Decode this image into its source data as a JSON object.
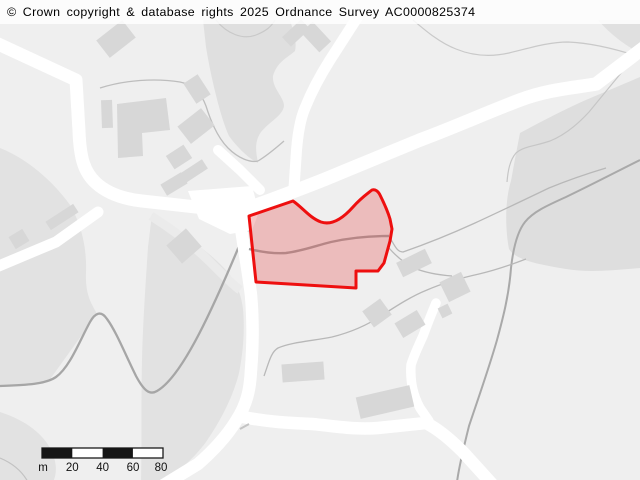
{
  "attribution": {
    "text": "© Crown copyright & database rights 2025 Ordnance Survey AC0000825374"
  },
  "scalebar": {
    "unit_label": "m",
    "tick_labels": [
      "20",
      "40",
      "60",
      "80"
    ],
    "segment_metres": 20,
    "total_metres": 80
  },
  "palette": {
    "background": "#efefef",
    "field_area": "#e2e2e2",
    "woodland_area": "#dfdfdf",
    "hillside_area": "#dedede",
    "road": "#ffffff",
    "building": "#d7d7d7",
    "contour": "#c9c9c9",
    "track": "#a6a6a6",
    "parcel_stroke": "#ee0f0f",
    "parcel_fill": "rgba(232,85,85,0.33)",
    "scalebar_dark": "#151515",
    "text": "#000000"
  },
  "map": {
    "width": 640,
    "height": 480,
    "layers": [
      {
        "name": "area-left-field",
        "kind": "path",
        "d": "M0,148 C30,160 55,184 70,205 C80,222 87,245 86,272 C85,296 92,304 97,314 L48,382 C32,386 15,387 0,387 Z",
        "fill": "#e2e2e2"
      },
      {
        "name": "area-bottomleft-field",
        "kind": "path",
        "d": "M0,412 C25,420 44,434 52,452 C58,466 56,476 53,482 L0,482 Z",
        "fill": "#e2e2e2"
      },
      {
        "name": "area-top-woodland",
        "kind": "path",
        "d": "M203,20 L290,20 C294,33 297,42 295,51 C287,58 277,62 273,76 C272,88 283,96 284,105 C284,115 269,122 261,132 C254,142 256,152 258,163 C248,158 237,147 229,136 C221,119 211,78 206,47 Z",
        "fill": "#dfdfdf"
      },
      {
        "name": "area-hillside",
        "kind": "path",
        "d": "M520,133 C546,119 573,105 600,94 L640,77 L640,268 C615,270 590,273 566,269 C543,265 516,261 509,249 C505,228 505,200 511,181 C514,164 517,148 520,133 Z",
        "fill": "#dedede"
      },
      {
        "name": "area-topright-corner",
        "kind": "path",
        "d": "M598,20 L640,20 L640,53 C626,46 611,35 598,20 Z",
        "fill": "#e0e0e0"
      },
      {
        "name": "area-center-field",
        "kind": "path",
        "d": "M152,214 C176,229 206,249 224,268 C236,281 241,293 243,309 C245,331 243,353 239,373 C233,397 221,420 206,442 C191,462 173,476 161,482 L141,482 C142,440 141,400 142,360 C143,320 146,278 148,247 Z",
        "fill": "#e2e2e2"
      },
      {
        "name": "track-junction-band",
        "kind": "path",
        "d": "M151,216 Q186,238 210,262 T240,290",
        "stroke": "#ebebeb",
        "width": 9
      },
      {
        "name": "contour-top-left",
        "kind": "path",
        "d": "M216,20 C227,34 243,40 256,35 C266,31 271,27 275,20",
        "stroke": "#c9c9c9",
        "width": 1.2
      },
      {
        "name": "contour-top-right",
        "kind": "path",
        "d": "M413,20 C426,31 440,43 456,49 C473,56 491,57 509,53 C530,48 548,42 568,42 C592,43 616,49 640,57",
        "stroke": "#c9c9c9",
        "width": 1.2
      },
      {
        "name": "contour-hillside",
        "kind": "path",
        "d": "M626,67 C612,84 599,100 589,112 C578,124 565,135 550,141 C536,146 524,146 516,153 C510,160 508,170 507,182",
        "stroke": "#c6c6c6",
        "width": 1.2
      },
      {
        "name": "track-scurve",
        "kind": "path",
        "d": "M0,386 C28,385 46,384 56,377 C70,367 80,340 90,322 C95,313 101,310 107,319 C116,331 126,356 136,376 C143,389 149,396 157,391 C171,383 186,359 199,334 C213,307 226,277 237,251 C241,241 244,234 248,230",
        "stroke": "#a6a6a6",
        "width": 2.3
      },
      {
        "name": "track-hillside-long",
        "kind": "path",
        "d": "M640,160 C616,172 591,185 566,197 C546,206 533,212 525,222 C517,232 513,250 511,268 C509,295 503,318 497,340 C489,368 479,396 469,426 C464,446 459,466 457,482",
        "stroke": "#a9a9a9",
        "width": 2
      },
      {
        "name": "path-upper-left",
        "kind": "path",
        "d": "M100,88 C125,80 155,78 180,82 C195,85 202,95 206,106 C211,122 218,138 228,148 C238,158 250,163 258,161 M258,161 C268,155 276,148 284,141",
        "stroke": "#bdbdbd",
        "width": 1.3
      },
      {
        "name": "path-hill-climb",
        "kind": "path",
        "d": "M390,238 C395,246 397,252 403,252 C426,244 451,234 475,223 C501,211 526,199 549,188 C566,181 586,174 606,168",
        "stroke": "#b8b8b8",
        "width": 1.3
      },
      {
        "name": "path-southeast",
        "kind": "path",
        "d": "M264,376 C269,362 271,352 278,348 C292,342 312,341 332,337 C352,332 368,325 384,314 C398,305 412,296 427,290 C443,283 461,278 479,274 C496,270 513,264 526,259",
        "stroke": "#b8b8b8",
        "width": 1.3
      },
      {
        "name": "path-polygon-east",
        "kind": "path",
        "d": "M389,248 C396,256 404,263 414,268 C426,273 439,275 452,276",
        "stroke": "#b8b8b8",
        "width": 1.3
      },
      {
        "name": "path-corner-arc",
        "kind": "path",
        "d": "M0,458 C12,463 22,471 28,482",
        "stroke": "#c2c2c2",
        "width": 1.2
      },
      {
        "name": "road-northwest",
        "kind": "path",
        "d": "M-6,42 L76,80 L79,131 C80,158 84,172 96,183 C108,194 124,199 142,201 L205,208 L240,212",
        "stroke": "#ffffff",
        "width": 13,
        "cap": "round",
        "join": "round"
      },
      {
        "name": "road-west-branch",
        "kind": "path",
        "d": "M98,212 L56,242 L-6,268",
        "stroke": "#ffffff",
        "width": 11,
        "cap": "round",
        "join": "round"
      },
      {
        "name": "road-north",
        "kind": "path",
        "d": "M357,18 L330,60 C318,79 311,93 305,108 C299,122 297,140 296,158 L294,188",
        "stroke": "#ffffff",
        "width": 11,
        "cap": "round",
        "join": "round"
      },
      {
        "name": "junction-area",
        "kind": "polygon",
        "pts": "188,191 252,186 259,212 252,230 230,234 199,219",
        "fill": "#ffffff"
      },
      {
        "name": "road-main-northeast",
        "kind": "path",
        "d": "M238,212 C275,198 305,188 340,173 L420,140 C455,127 488,112 520,100 C546,90 571,88 596,84 L646,46",
        "stroke": "#ffffff",
        "width": 13.5,
        "cap": "round",
        "join": "round"
      },
      {
        "name": "road-lane-cap",
        "kind": "path",
        "d": "M218,150 L240,170 L260,190",
        "stroke": "#ffffff",
        "width": 10,
        "cap": "round",
        "join": "round"
      },
      {
        "name": "road-south",
        "kind": "path",
        "d": "M240,220 C243,245 248,270 251,295 C253,318 253,345 251,370 C250,390 247,404 236,421 C227,436 212,452 198,464 L162,486",
        "stroke": "#ffffff",
        "width": 12.5,
        "cap": "round",
        "join": "round"
      },
      {
        "name": "road-bottom-east",
        "kind": "path",
        "d": "M243,417 C268,422 290,423 312,424 C334,426 356,430 378,428 L426,423 C438,429 452,441 463,452 L492,484",
        "stroke": "#ffffff",
        "width": 12.5,
        "cap": "round",
        "join": "round"
      },
      {
        "name": "road-driveway",
        "kind": "path",
        "d": "M436,303 C431,315 427,325 423,336 C418,347 414,355 411,365 C410,382 413,395 420,408 L429,421",
        "stroke": "#ffffff",
        "width": 9.5,
        "cap": "round",
        "join": "round"
      },
      {
        "name": "building",
        "kind": "rrect",
        "cx": 116,
        "cy": 39,
        "w": 33,
        "h": 22,
        "rot": -38,
        "fill": "#d7d7d7"
      },
      {
        "name": "building",
        "kind": "rrect",
        "cx": 107,
        "cy": 114,
        "w": 11,
        "h": 28,
        "rot": -2,
        "fill": "#d7d7d7"
      },
      {
        "name": "building-l-shape",
        "kind": "polygon",
        "pts": "117,104 166,98 170,130 142,133 143,156 118,158",
        "fill": "#d7d7d7"
      },
      {
        "name": "building",
        "kind": "rrect",
        "cx": 197,
        "cy": 89,
        "w": 17,
        "h": 24,
        "rot": -33,
        "fill": "#d7d7d7"
      },
      {
        "name": "building",
        "kind": "rrect",
        "cx": 196,
        "cy": 126,
        "w": 30,
        "h": 22,
        "rot": -38,
        "fill": "#d7d7d7"
      },
      {
        "name": "building",
        "kind": "rrect",
        "cx": 179,
        "cy": 157,
        "w": 21,
        "h": 16,
        "rot": -33,
        "fill": "#d7d7d7"
      },
      {
        "name": "building",
        "kind": "rrect",
        "cx": 194,
        "cy": 171,
        "w": 26,
        "h": 11,
        "rot": -33,
        "fill": "#d7d7d7"
      },
      {
        "name": "building",
        "kind": "rrect",
        "cx": 174,
        "cy": 184,
        "w": 24,
        "h": 13,
        "rot": -31,
        "fill": "#d7d7d7"
      },
      {
        "name": "building",
        "kind": "rrect",
        "cx": 184,
        "cy": 246,
        "w": 26,
        "h": 24,
        "rot": -41,
        "fill": "#d7d7d7"
      },
      {
        "name": "building",
        "kind": "rrect",
        "cx": 62,
        "cy": 217,
        "w": 33,
        "h": 10,
        "rot": -33,
        "fill": "#d7d7d7"
      },
      {
        "name": "building",
        "kind": "rrect",
        "cx": 19,
        "cy": 239,
        "w": 16,
        "h": 14,
        "rot": -31,
        "fill": "#d7d7d7"
      },
      {
        "name": "building",
        "kind": "rrect",
        "cx": 296,
        "cy": 33,
        "w": 26,
        "h": 13,
        "rot": -43,
        "fill": "#d7d7d7"
      },
      {
        "name": "building",
        "kind": "rrect",
        "cx": 316,
        "cy": 37,
        "w": 16,
        "h": 27,
        "rot": -43,
        "fill": "#d7d7d7"
      },
      {
        "name": "building",
        "kind": "rrect",
        "cx": 414,
        "cy": 263,
        "w": 32,
        "h": 16,
        "rot": -26,
        "fill": "#d7d7d7"
      },
      {
        "name": "building",
        "kind": "rrect",
        "cx": 455,
        "cy": 287,
        "w": 24,
        "h": 22,
        "rot": -26,
        "fill": "#d7d7d7"
      },
      {
        "name": "building",
        "kind": "rrect",
        "cx": 445,
        "cy": 311,
        "w": 11,
        "h": 11,
        "rot": -26,
        "fill": "#d7d7d7"
      },
      {
        "name": "building",
        "kind": "rrect",
        "cx": 377,
        "cy": 313,
        "w": 22,
        "h": 20,
        "rot": -36,
        "fill": "#d7d7d7"
      },
      {
        "name": "building",
        "kind": "rrect",
        "cx": 410,
        "cy": 324,
        "w": 26,
        "h": 17,
        "rot": -31,
        "fill": "#d7d7d7"
      },
      {
        "name": "building",
        "kind": "rrect",
        "cx": 385,
        "cy": 402,
        "w": 55,
        "h": 22,
        "rot": -13,
        "fill": "#d7d7d7"
      },
      {
        "name": "building",
        "kind": "rrect",
        "cx": 303,
        "cy": 372,
        "w": 42,
        "h": 18,
        "rot": -4,
        "fill": "#d7d7d7"
      },
      {
        "name": "wall-fragment",
        "kind": "path",
        "d": "M240,429 L249,424",
        "stroke": "#c4c4c4",
        "width": 2
      },
      {
        "name": "path-through-parcel",
        "kind": "path",
        "d": "M249,249 C262,252 274,254 286,253 C302,251 315,246 331,242 C349,238 368,236 389,236",
        "stroke": "#9e9e9e",
        "width": 2.4
      },
      {
        "name": "selected-parcel",
        "kind": "path",
        "interactable": true,
        "d": "M249,216 L293,201 C303,208 310,218 321,222 C333,226 345,216 353,207 C361,198 367,194 372,190 C375,189 378,191 380,195 C384,203 388,212 390,219 L392,229 L390,241 L384,263 L378,271 L356,271 L356,288 L256,282 Z",
        "fill": "rgba(232,85,85,0.33)",
        "stroke": "#ee0f0f",
        "width": 3,
        "join": "round"
      },
      {
        "name": "attribution-backdrop",
        "kind": "rect",
        "x": 0,
        "y": 0,
        "w": 640,
        "h": 24,
        "fill": "rgba(255,255,255,0.82)"
      },
      {
        "name": "scalebar-outline",
        "kind": "rect",
        "x": 42,
        "y": 448,
        "w": 121,
        "h": 10,
        "fill": "#ffffff",
        "stroke": "#1a1a1a",
        "width": 1.3
      },
      {
        "name": "scalebar-seg-1",
        "kind": "rect",
        "x": 42,
        "y": 448,
        "w": 30.3,
        "h": 10,
        "fill": "#151515"
      },
      {
        "name": "scalebar-seg-3",
        "kind": "rect",
        "x": 102.6,
        "y": 448,
        "w": 30.3,
        "h": 10,
        "fill": "#151515"
      },
      {
        "name": "scalebar-label-unit",
        "kind": "text",
        "x": 43,
        "y": 471,
        "text": "m",
        "size": 11.5
      },
      {
        "name": "scalebar-label-20",
        "kind": "text",
        "x": 72.3,
        "y": 471,
        "text": "20",
        "size": 11.5
      },
      {
        "name": "scalebar-label-40",
        "kind": "text",
        "x": 102.6,
        "y": 471,
        "text": "40",
        "size": 11.5
      },
      {
        "name": "scalebar-label-60",
        "kind": "text",
        "x": 133,
        "y": 471,
        "text": "60",
        "size": 11.5
      },
      {
        "name": "scalebar-label-80",
        "kind": "text",
        "x": 161,
        "y": 471,
        "text": "80",
        "size": 11.5
      }
    ]
  }
}
